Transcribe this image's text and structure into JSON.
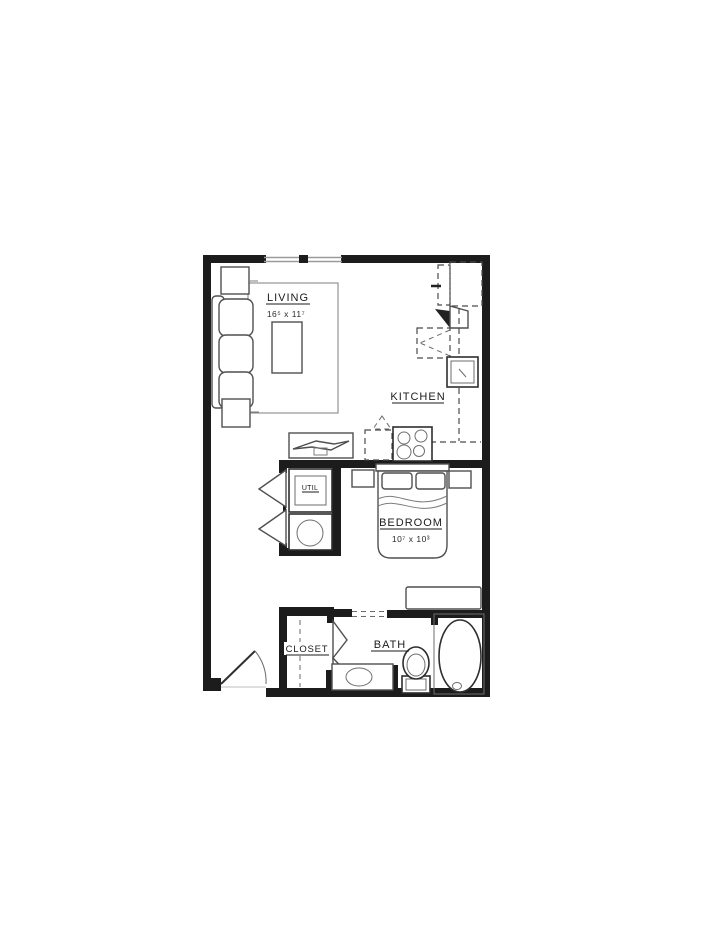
{
  "plan": {
    "background_color": "#ffffff",
    "wall_color": "#1c1c1c",
    "furniture_line_color": "#4f4f4f",
    "rooms": {
      "living": {
        "label": "LIVING",
        "dims": "16⁵ x 11⁷"
      },
      "kitchen": {
        "label": "KITCHEN"
      },
      "bedroom": {
        "label": "BEDROOM",
        "dims": "10⁷ x 10³"
      },
      "util": {
        "label": "UTIL"
      },
      "closet": {
        "label": "CLOSET"
      },
      "bath": {
        "label": "BATH"
      }
    }
  }
}
